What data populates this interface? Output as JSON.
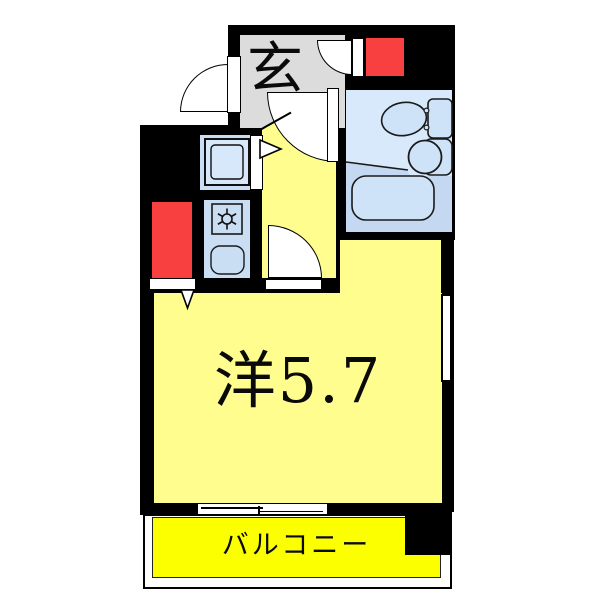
{
  "plan": {
    "type": "apartment-floor-plan",
    "labels": {
      "entrance": "玄",
      "main_room": "洋5.7",
      "balcony": "バルコニー"
    },
    "rooms": [
      {
        "name": "entrance",
        "label": "玄",
        "color": "#dcdcdc"
      },
      {
        "name": "main-room",
        "label": "洋5.7",
        "size_tatami": 5.7,
        "color": "#fffd8e"
      },
      {
        "name": "balcony",
        "label": "バルコニー",
        "color": "#fcff00"
      },
      {
        "name": "bathroom",
        "label": "",
        "color": "#d7e9fb"
      },
      {
        "name": "kitchen",
        "label": "",
        "color": "#c9ddf3"
      }
    ],
    "colors": {
      "wall": "#000000",
      "room_yellow": "#fffd8e",
      "balcony_yellow": "#fcff00",
      "entrance_gray": "#dcdcdc",
      "red_block": "#f94040",
      "bath_light": "#d7e9fb",
      "bath_dark": "#c4d8f2",
      "fixture_blue": "#cfe3f8",
      "kitchen_blue": "#c9ddf3",
      "outline": "#000000"
    },
    "fixtures": [
      "toilet",
      "washbasin",
      "bathtub",
      "stove-burner",
      "kitchen-sink",
      "washing-machine"
    ]
  }
}
